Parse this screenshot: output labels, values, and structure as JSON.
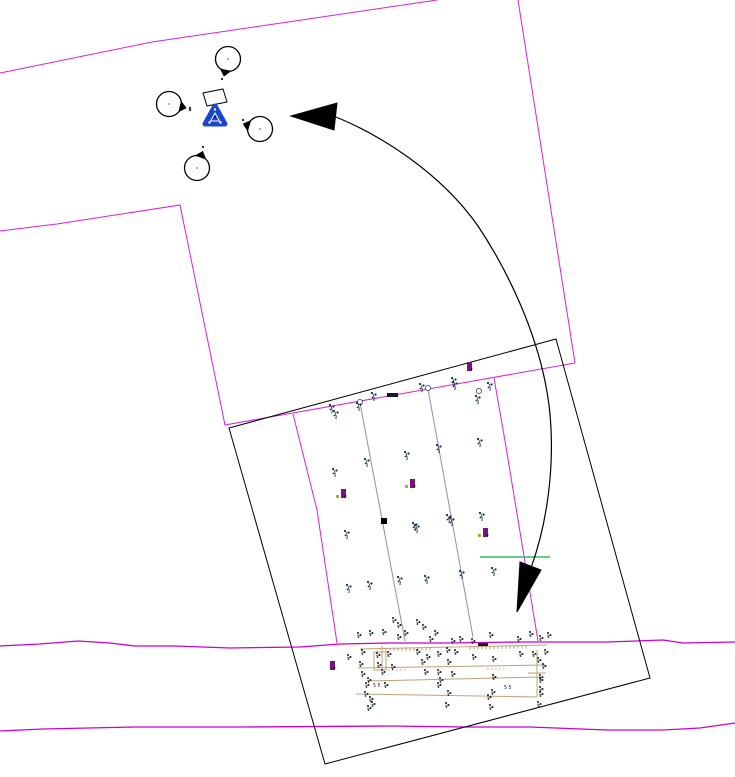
{
  "canvas": {
    "width": 735,
    "height": 777,
    "background": "#ffffff"
  },
  "palette": {
    "magenta": "#da1fda",
    "road_magenta": "#cc00cc",
    "black": "#000000",
    "row_gray": "#8f8fa8",
    "tan": "#c2a176",
    "tan_dark": "#ab8b5c",
    "green": "#2ec05a",
    "blue": "#1c44cc",
    "purple": "#79117e",
    "olive_dot": "#a8a820",
    "glyph_dark": "#15303a",
    "dense_glyph": "#121f22",
    "marker_gray": "#555555"
  },
  "boundary_lines": [
    {
      "name": "upper-left-boundary",
      "points": [
        [
          0,
          73
        ],
        [
          152,
          42
        ],
        [
          437,
          0
        ]
      ]
    },
    {
      "name": "parcel-boundary",
      "points": [
        [
          0,
          231
        ],
        [
          57,
          224
        ],
        [
          180,
          205
        ],
        [
          225,
          425
        ],
        [
          575,
          363
        ],
        [
          518,
          0
        ]
      ]
    },
    {
      "name": "right-hang-boundary",
      "points": [
        [
          494,
          378
        ],
        [
          505,
          441
        ],
        [
          538,
          641
        ]
      ]
    },
    {
      "name": "left-hang-boundary",
      "points": [
        [
          293,
          414
        ],
        [
          317,
          510
        ],
        [
          337,
          643
        ]
      ]
    }
  ],
  "road_lines": [
    {
      "name": "upper-road-line",
      "points": [
        [
          0,
          646
        ],
        [
          40,
          644
        ],
        [
          78,
          641
        ],
        [
          110,
          643
        ],
        [
          135,
          646
        ],
        [
          175,
          646
        ],
        [
          230,
          648
        ],
        [
          300,
          647
        ],
        [
          340,
          644
        ],
        [
          390,
          643
        ],
        [
          450,
          643
        ],
        [
          520,
          642
        ],
        [
          547,
          642
        ],
        [
          607,
          642
        ],
        [
          663,
          640
        ],
        [
          683,
          643
        ],
        [
          735,
          642
        ]
      ]
    },
    {
      "name": "lower-road-line",
      "points": [
        [
          0,
          731
        ],
        [
          43,
          729
        ],
        [
          135,
          727
        ],
        [
          245,
          727
        ],
        [
          390,
          726
        ],
        [
          465,
          727
        ],
        [
          530,
          727
        ],
        [
          607,
          730
        ],
        [
          663,
          730
        ],
        [
          700,
          728
        ],
        [
          735,
          723
        ]
      ]
    }
  ],
  "field_rectangle": {
    "points": [
      [
        229,
        428
      ],
      [
        556,
        339
      ],
      [
        650,
        678
      ],
      [
        325,
        764
      ]
    ]
  },
  "row_lines": [
    {
      "points": [
        [
          360,
          403
        ],
        [
          405,
          641
        ]
      ]
    },
    {
      "points": [
        [
          428,
          389
        ],
        [
          473,
          637
        ]
      ]
    }
  ],
  "row_end_circles": [
    [
      360,
      402
    ],
    [
      428,
      388
    ],
    [
      479,
      391
    ]
  ],
  "tan_lines": [
    {
      "points": [
        [
          360,
          649
        ],
        [
          547,
          645
        ]
      ]
    },
    {
      "points": [
        [
          358,
          668
        ],
        [
          545,
          665
        ]
      ]
    },
    {
      "points": [
        [
          368,
          681
        ],
        [
          540,
          677
        ]
      ]
    },
    {
      "points": [
        [
          356,
          694
        ],
        [
          537,
          697
        ]
      ]
    },
    {
      "points": [
        [
          537,
          650
        ],
        [
          537,
          697
        ]
      ]
    },
    {
      "points": [
        [
          382,
          646
        ],
        [
          382,
          670
        ]
      ]
    },
    {
      "points": [
        [
          528,
          673
        ],
        [
          546,
          673
        ]
      ]
    },
    {
      "points": [
        [
          374,
          652
        ],
        [
          386,
          652
        ],
        [
          386,
          670
        ],
        [
          374,
          670
        ],
        [
          374,
          652
        ]
      ]
    }
  ],
  "tan_dashed": [
    {
      "points": [
        [
          487,
          669
        ],
        [
          507,
          669
        ]
      ]
    },
    {
      "points": [
        [
          388,
          670
        ],
        [
          408,
          670
        ]
      ]
    }
  ],
  "tan_ticks": [
    {
      "line": [
        [
          360,
          649
        ],
        [
          547,
          645
        ]
      ],
      "x1": 386,
      "x2": 430,
      "step": 4,
      "len": 3
    },
    {
      "line": [
        [
          360,
          649
        ],
        [
          547,
          645
        ]
      ],
      "x1": 470,
      "x2": 528,
      "step": 4,
      "len": 3
    }
  ],
  "rotation_arrow": {
    "path": "M336,117 C380,135 440,172 478,226 C506,268 540,335 549,405 C555,455 550,515 531,568",
    "heads": [
      [
        [
          291,
          116
        ],
        [
          337,
          103
        ],
        [
          334,
          130
        ]
      ],
      [
        [
          517,
          612
        ],
        [
          541,
          570
        ],
        [
          520,
          562
        ]
      ]
    ]
  },
  "tree_symbols": [
    {
      "cx": 228,
      "cy": 59,
      "r": 12.5,
      "wedge_deg": 103
    },
    {
      "cx": 169,
      "cy": 104,
      "r": 12.5,
      "wedge_deg": 13
    },
    {
      "cx": 260,
      "cy": 129,
      "r": 12.5,
      "wedge_deg": 197
    },
    {
      "cx": 197,
      "cy": 168,
      "r": 12.5,
      "wedge_deg": -71
    }
  ],
  "survey_symbol": {
    "x": 215,
    "y": 116
  },
  "white_quad": {
    "points": [
      [
        203,
        93
      ],
      [
        223,
        89
      ],
      [
        227,
        102
      ],
      [
        207,
        106
      ]
    ]
  },
  "cluster_dots": [
    [
      222,
      79
    ],
    [
      190,
      110
    ],
    [
      243,
      120
    ],
    [
      203,
      147
    ],
    [
      190,
      108
    ]
  ],
  "green_line": {
    "points": [
      [
        480,
        557
      ],
      [
        550,
        557
      ]
    ]
  },
  "dark_bars": [
    {
      "x": 387,
      "y": 393,
      "w": 11,
      "h": 4
    },
    {
      "x": 478,
      "y": 643,
      "w": 10,
      "h": 3
    }
  ],
  "black_square": {
    "x": 381,
    "y": 518,
    "w": 6,
    "h": 6
  },
  "purple_markers": [
    {
      "x": 343,
      "y": 494,
      "dot": true
    },
    {
      "x": 412,
      "y": 484,
      "dot": true
    },
    {
      "x": 485,
      "y": 533,
      "dot": true
    },
    {
      "x": 332,
      "y": 666,
      "dot": false
    },
    {
      "x": 469,
      "y": 367,
      "dot": false
    }
  ],
  "plant_glyphs": [
    [
      330,
      405
    ],
    [
      334,
      411
    ],
    [
      357,
      403
    ],
    [
      372,
      393
    ],
    [
      420,
      384
    ],
    [
      452,
      378
    ],
    [
      453,
      382
    ],
    [
      488,
      383
    ],
    [
      476,
      396
    ],
    [
      365,
      459
    ],
    [
      333,
      469
    ],
    [
      405,
      452
    ],
    [
      437,
      445
    ],
    [
      478,
      439
    ],
    [
      447,
      515
    ],
    [
      415,
      525
    ],
    [
      480,
      513
    ],
    [
      345,
      531
    ],
    [
      413,
      523
    ],
    [
      450,
      518
    ],
    [
      398,
      577
    ],
    [
      425,
      576
    ],
    [
      460,
      571
    ],
    [
      492,
      568
    ],
    [
      347,
      585
    ],
    [
      368,
      582
    ]
  ],
  "dense_glyphs": [
    [
      393,
      618
    ],
    [
      398,
      623
    ],
    [
      417,
      620
    ],
    [
      423,
      625
    ],
    [
      358,
      633
    ],
    [
      370,
      631
    ],
    [
      383,
      630
    ],
    [
      398,
      635
    ],
    [
      405,
      631
    ],
    [
      430,
      637
    ],
    [
      435,
      631
    ],
    [
      452,
      639
    ],
    [
      460,
      637
    ],
    [
      472,
      639
    ],
    [
      490,
      633
    ],
    [
      518,
      637
    ],
    [
      530,
      632
    ],
    [
      540,
      636
    ],
    [
      548,
      633
    ],
    [
      348,
      655
    ],
    [
      362,
      650
    ],
    [
      377,
      653
    ],
    [
      388,
      652
    ],
    [
      417,
      650
    ],
    [
      427,
      655
    ],
    [
      438,
      652
    ],
    [
      447,
      648
    ],
    [
      455,
      650
    ],
    [
      473,
      655
    ],
    [
      493,
      657
    ],
    [
      520,
      652
    ],
    [
      533,
      652
    ],
    [
      545,
      650
    ],
    [
      360,
      662
    ],
    [
      378,
      663
    ],
    [
      392,
      665
    ],
    [
      422,
      660
    ],
    [
      448,
      660
    ],
    [
      538,
      658
    ],
    [
      543,
      664
    ],
    [
      362,
      672
    ],
    [
      382,
      670
    ],
    [
      425,
      670
    ],
    [
      438,
      670
    ],
    [
      452,
      672
    ],
    [
      493,
      675
    ],
    [
      540,
      675
    ],
    [
      368,
      678
    ],
    [
      440,
      678
    ],
    [
      540,
      678
    ],
    [
      366,
      683
    ],
    [
      385,
      683
    ],
    [
      438,
      683
    ],
    [
      492,
      690
    ],
    [
      540,
      687
    ],
    [
      365,
      692
    ],
    [
      448,
      691
    ],
    [
      370,
      697
    ],
    [
      488,
      695
    ],
    [
      540,
      692
    ],
    [
      368,
      706
    ],
    [
      372,
      702
    ],
    [
      446,
      703
    ],
    [
      490,
      705
    ],
    [
      538,
      702
    ]
  ],
  "elevation_labels": [
    {
      "text": "55",
      "x": 373,
      "y": 687
    },
    {
      "text": "55",
      "x": 504,
      "y": 689
    }
  ]
}
